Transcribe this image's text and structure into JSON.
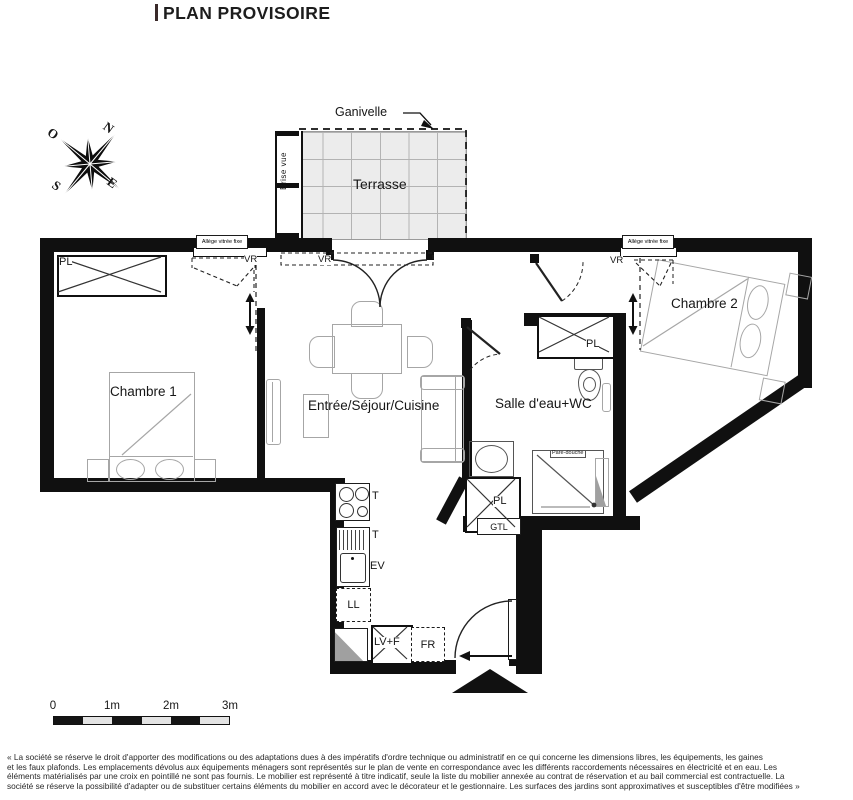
{
  "header": {
    "title": "PLAN PROVISOIRE"
  },
  "compass": {
    "n": "N",
    "e": "E",
    "s": "S",
    "o": "O"
  },
  "plan": {
    "terrasse": "Terrasse",
    "ganivelle": "Ganivelle",
    "brise_vue": "Brise vue",
    "allege": "Allège vitrée fixe",
    "vr": "VR",
    "chambre1": "Chambre 1",
    "chambre2": "Chambre 2",
    "sejour": "Entrée/Séjour/Cuisine",
    "salle_eau": "Salle d'eau+WC",
    "pl": "PL",
    "gtl": "GTL",
    "t": "T",
    "ev": "EV",
    "ll": "LL",
    "lvf": "LV+F",
    "fr": "FR",
    "pare_douche": "Pare-douche"
  },
  "scale_bar": {
    "t0": "0",
    "t1": "1m",
    "t2": "2m",
    "t3": "3m"
  },
  "disclaimer": {
    "lines": [
      "« La société se réserve le droit d'apporter des modifications ou des adaptations dues à des impératifs d'ordre technique ou administratif en ce qui concerne les dimensions libres, les équipements, les gaines",
      "et les faux plafonds. Les emplacements dévolus aux équipements ménagers sont représentés sur le plan de vente en correspondance avec les différents raccordements nécessaires en électricité et en eau. Les",
      "éléments matérialisés par une croix en pointillé ne sont pas fournis. Le mobilier est représenté à titre indicatif, seule la liste du mobilier annexée au contrat de réservation et au bail commercial est contractuelle. La",
      "société se réserve la possibilité d'adapter ou de substituer certains éléments du mobilier en accord avec le décorateur et le gestionnaire. Les surfaces des jardins sont approximatives et susceptibles d'être modifiées »"
    ]
  }
}
